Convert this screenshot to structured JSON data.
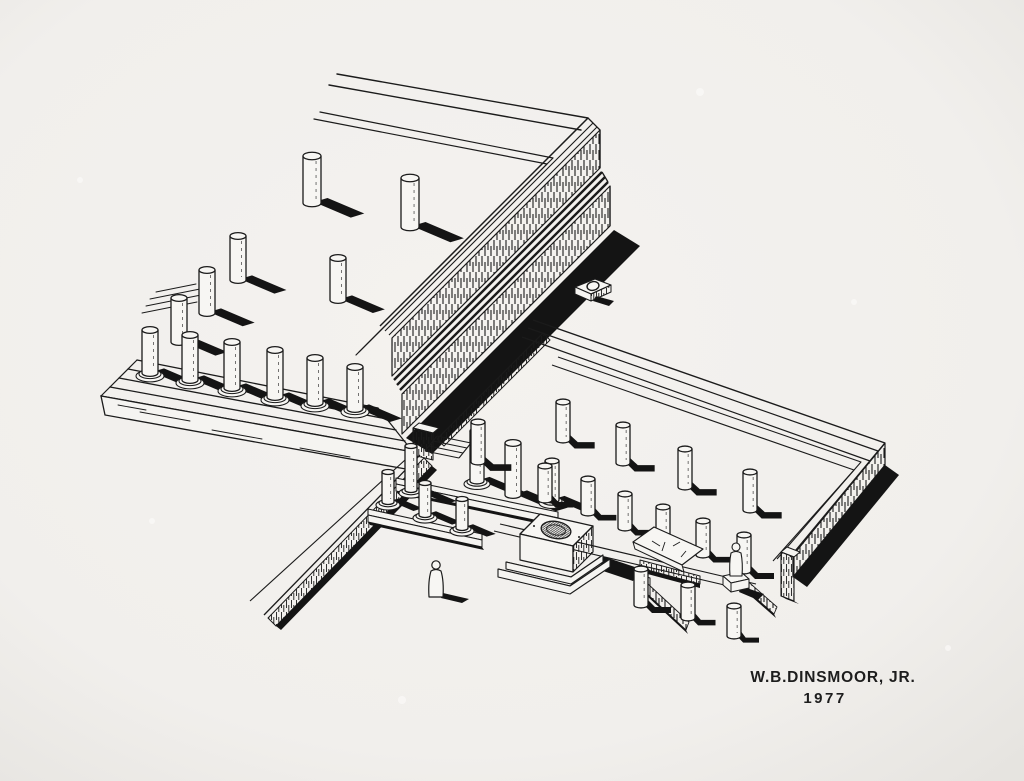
{
  "canvas": {
    "width": 1024,
    "height": 781,
    "paper": "#f2f0ed",
    "paper_center": "#f4f2ef",
    "paper_edge": "#e6e4e0",
    "ink": "#1b1b1b",
    "shadow": "#141414",
    "face": "#f5f4f1"
  },
  "signature": {
    "line1": "W.B.DINSMOOR, JR.",
    "line2": "1977"
  },
  "scene": {
    "description": "Black-ink axonometric reconstruction drawing of a ruined classical sanctuary: a stepped temple platform with unfluted column stumps (upper left) above a tall hatched terrace wall, a gateway of column bases, a low-walled courtyard with interior colonnade stumps, a central stepped altar with oval basin, a fallen inscribed stele, precinct fences, a small statue on a base, an isolated socle block with a circular cutting, a long temenos wall running southwest, and a human figure for scale.",
    "shadow_angle_deg": 23,
    "shadow_len_factor": 0.85,
    "columns": {
      "platform": [
        [
          312,
          203,
          47,
          9,
          0
        ],
        [
          410,
          227,
          49,
          9,
          0
        ],
        [
          238,
          280,
          44,
          8,
          0
        ],
        [
          338,
          300,
          42,
          8,
          0
        ],
        [
          207,
          313,
          43,
          8,
          0
        ],
        [
          179,
          342,
          44,
          8,
          0
        ],
        [
          150,
          373,
          43,
          8,
          1
        ],
        [
          190,
          380,
          45,
          8,
          1
        ],
        [
          232,
          388,
          46,
          8,
          1
        ],
        [
          275,
          397,
          47,
          8,
          1
        ],
        [
          315,
          403,
          45,
          8,
          1
        ],
        [
          355,
          409,
          42,
          8,
          1
        ]
      ],
      "gateway": [
        [
          411,
          490,
          44,
          6,
          1
        ],
        [
          477,
          481,
          50,
          7,
          1
        ],
        [
          513,
          495,
          52,
          8,
          0
        ],
        [
          552,
          500,
          39,
          7,
          1
        ],
        [
          388,
          502,
          30,
          6,
          1
        ],
        [
          425,
          515,
          32,
          6,
          1
        ],
        [
          462,
          528,
          29,
          6,
          1
        ]
      ],
      "courtyard": [
        [
          563,
          440,
          38,
          7,
          0
        ],
        [
          623,
          463,
          38,
          7,
          0
        ],
        [
          685,
          487,
          38,
          7,
          0
        ],
        [
          750,
          510,
          38,
          7,
          0
        ],
        [
          478,
          462,
          40,
          7,
          0
        ],
        [
          545,
          500,
          34,
          7,
          0
        ],
        [
          588,
          513,
          34,
          7,
          0
        ],
        [
          625,
          528,
          34,
          7,
          0
        ],
        [
          663,
          541,
          34,
          7,
          0
        ],
        [
          703,
          555,
          34,
          7,
          0
        ],
        [
          744,
          571,
          36,
          7,
          0
        ]
      ],
      "southeast": [
        [
          641,
          605,
          36,
          7,
          0
        ],
        [
          688,
          618,
          33,
          7,
          0
        ],
        [
          734,
          636,
          30,
          7,
          0
        ]
      ]
    }
  }
}
